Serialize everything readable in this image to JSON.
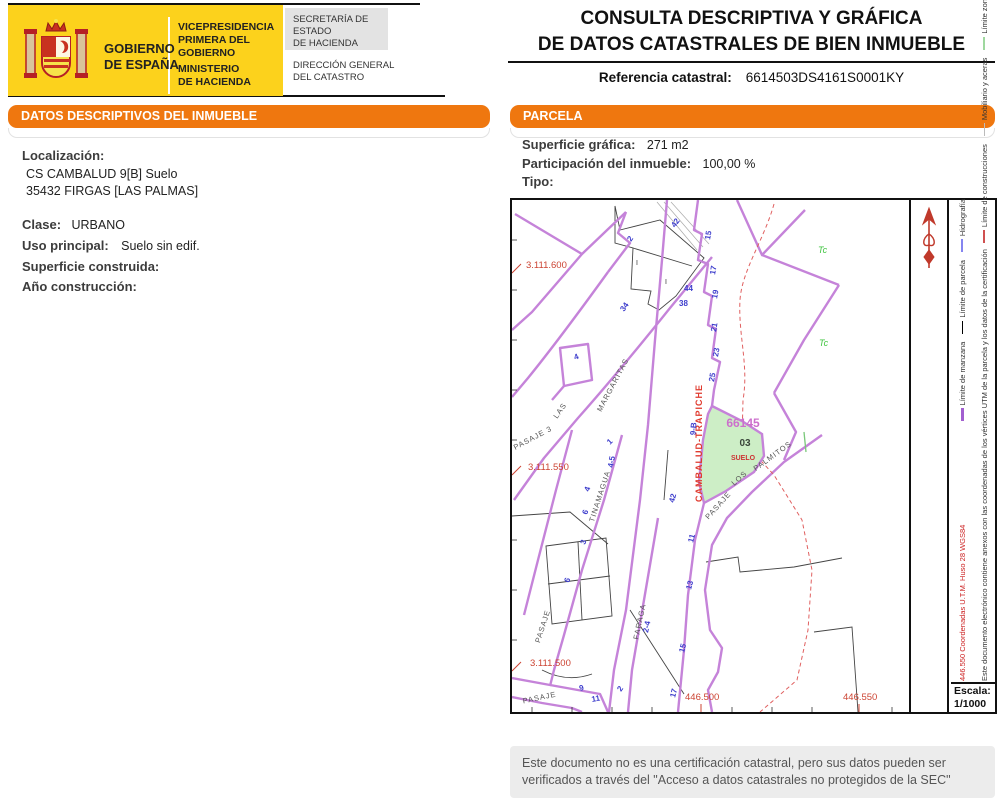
{
  "colors": {
    "accent_orange": "#ef770f",
    "logo_yellow": "#fcd21c",
    "manzana_purple": "#c583d9",
    "construction_red": "#d05050",
    "parcel_green_fill": "#cdeec6",
    "house_number_blue": "#3d3dcc",
    "coordinate_red": "#cc4433"
  },
  "header": {
    "logo": {
      "gob_l1": "GOBIERNO",
      "gob_l2": "DE ESPAÑA",
      "vice_l1": "VICEPRESIDENCIA",
      "vice_l2": "PRIMERA DEL GOBIERNO",
      "min_l1": "MINISTERIO",
      "min_l2": "DE HACIENDA",
      "sec_l1": "SECRETARÍA DE ESTADO",
      "sec_l2": "DE HACIENDA",
      "dir_l1": "DIRECCIÓN GENERAL",
      "dir_l2": "DEL CATASTRO"
    },
    "title_line1": "CONSULTA DESCRIPTIVA Y GRÁFICA",
    "title_line2": "DE DATOS CATASTRALES DE BIEN INMUEBLE",
    "ref_label": "Referencia catastral:",
    "ref_value": "6614503DS4161S0001KY"
  },
  "datos": {
    "panel_title": "DATOS DESCRIPTIVOS DEL INMUEBLE",
    "localizacion_label": "Localización:",
    "localizacion_line1": "CS CAMBALUD 9[B] Suelo",
    "localizacion_line2": "35432 FIRGAS [LAS PALMAS]",
    "clase_label": "Clase:",
    "clase_value": "URBANO",
    "uso_label": "Uso principal:",
    "uso_value": "Suelo sin edif.",
    "superficie_label": "Superficie construida:",
    "superficie_value": "",
    "anio_label": "Año construcción:",
    "anio_value": ""
  },
  "parcela": {
    "panel_title": "PARCELA",
    "superficie_label": "Superficie gráfica:",
    "superficie_value": "271 m2",
    "participacion_label": "Participación del inmueble:",
    "participacion_value": "100,00 %",
    "tipo_label": "Tipo:",
    "tipo_value": ""
  },
  "map": {
    "coords": {
      "y1": "3.111.600",
      "y2": "3.111.550",
      "y3": "3.111.500",
      "x1": "446.500",
      "x2": "446.550"
    },
    "streets": {
      "las": "LAS",
      "margaritas": "MARGARITAS",
      "cambalud": "CAMBALUD-TRAPICHE",
      "tinamagua": "TINAMAGUA",
      "pasaje3": "PASAJE 3",
      "pasaje_w": "PASAJE",
      "faraga": "FARAGA",
      "pasaje_s": "PASAJE",
      "palmitos_a": "PASAJE",
      "palmitos_b": "LOS",
      "palmitos_c": "PALMITOS"
    },
    "parcel": {
      "manzana": "66145",
      "local": "03",
      "uso": "SUELO",
      "numero": "9-B"
    },
    "tc": "Tc",
    "construction_mark": "I",
    "house_numbers": [
      "42",
      "44",
      "38",
      "15",
      "17",
      "19",
      "21",
      "23",
      "25",
      "2",
      "34",
      "4",
      "1",
      "4-5",
      "42",
      "11",
      "13",
      "15",
      "17",
      "2-4",
      "2",
      "9",
      "11",
      "4",
      "6",
      "3",
      "6"
    ],
    "legend": {
      "items": [
        {
          "label": "Límite de manzana",
          "color": "#a25fd0"
        },
        {
          "label": "Límite de parcela",
          "color": "#000000"
        },
        {
          "label": "Hidrografía",
          "color": "#8585f0"
        },
        {
          "label": "Límite de construcciones",
          "color": "#d05050"
        },
        {
          "label": "Mobiliario y aceras",
          "color": "#bbbbbb"
        },
        {
          "label": "Límite zona verde",
          "color": "#9fd89f"
        }
      ]
    },
    "notes": {
      "red": "446.550 Coordenadas U.T.M. Huso 28 WGS84",
      "black": "Este documento electrónico contiene anexos con las coordenadas de los vértices UTM de la parcela y los datos de la certificación"
    },
    "escala_label": "Escala:",
    "escala_value": "1/1000"
  },
  "footer": {
    "note": "Este documento no es una certificación catastral, pero sus datos pueden ser verificados a través del \"Acceso a datos catastrales no protegidos de la SEC\""
  }
}
